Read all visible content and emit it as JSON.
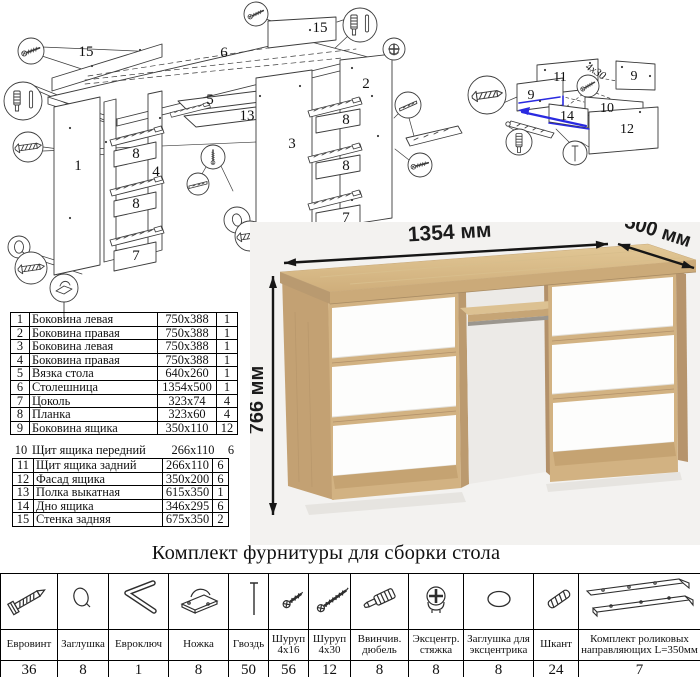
{
  "hardware_title": "Комплект фурнитуры для сборки стола",
  "dimensions": {
    "width": "1354 мм",
    "depth": "500 мм",
    "height": "766 мм"
  },
  "colors": {
    "wood": "#d2b282",
    "wood_dark": "#c5a372",
    "drawer_white": "#fdfdfc",
    "highlight_blue": "#2a2ae0",
    "photo_bg": "#f3f2f0",
    "line": "#3c3c3c"
  },
  "parts": {
    "rows": [
      {
        "num": "1",
        "name": "Боковина левая",
        "size": "750x388",
        "qty": "1"
      },
      {
        "num": "2",
        "name": "Боковина правая",
        "size": "750x388",
        "qty": "1"
      },
      {
        "num": "3",
        "name": "Боковина левая",
        "size": "750x388",
        "qty": "1"
      },
      {
        "num": "4",
        "name": "Боковина правая",
        "size": "750x388",
        "qty": "1"
      },
      {
        "num": "5",
        "name": "Вязка стола",
        "size": "640x260",
        "qty": "1"
      },
      {
        "num": "6",
        "name": "Столешница",
        "size": "1354x500",
        "qty": "1"
      },
      {
        "num": "7",
        "name": "Цоколь",
        "size": "323x74",
        "qty": "4"
      },
      {
        "num": "8",
        "name": "Планка",
        "size": "323x60",
        "qty": "4"
      },
      {
        "num": "9",
        "name": "Боковина ящика",
        "size": "350x110",
        "qty": "12"
      },
      {
        "num": "10",
        "name": "Щит ящика передний",
        "size": "266x110",
        "qty": "6"
      },
      {
        "num": "11",
        "name": "Щит ящика задний",
        "size": "266x110",
        "qty": "6"
      },
      {
        "num": "12",
        "name": "Фасад ящика",
        "size": "350x200",
        "qty": "6"
      },
      {
        "num": "13",
        "name": "Полка выкатная",
        "size": "615x350",
        "qty": "1"
      },
      {
        "num": "14",
        "name": "Дно ящика",
        "size": "346x295",
        "qty": "6"
      },
      {
        "num": "15",
        "name": "Стенка задняя",
        "size": "675x350",
        "qty": "2"
      }
    ]
  },
  "hardware": {
    "items": [
      {
        "icon": "euro-screw-icon",
        "name": "Евровинт",
        "qty": "36"
      },
      {
        "icon": "cap-icon",
        "name": "Заглушка",
        "qty": "8"
      },
      {
        "icon": "hex-key-icon",
        "name": "Евроключ",
        "qty": "1"
      },
      {
        "icon": "foot-icon",
        "name": "Ножка",
        "qty": "8"
      },
      {
        "icon": "nail-icon",
        "name": "Гвоздь",
        "qty": "50"
      },
      {
        "icon": "screw-4x16-icon",
        "name": "Шуруп\n4x16",
        "qty": "56"
      },
      {
        "icon": "screw-4x30-icon",
        "name": "Шуруп\n4x30",
        "qty": "12"
      },
      {
        "icon": "screw-dowel-icon",
        "name": "Ввинчив.\nдюбель",
        "qty": "8"
      },
      {
        "icon": "cam-lock-icon",
        "name": "Эксцентр.\nстяжка",
        "qty": "8"
      },
      {
        "icon": "cam-cap-icon",
        "name": "Заглушка для\nэксцентрика",
        "qty": "8"
      },
      {
        "icon": "dowel-icon",
        "name": "Шкант",
        "qty": "24"
      },
      {
        "icon": "drawer-slides-icon",
        "name": "Комплект роликовых\nнаправляющих L=350мм",
        "qty": "7"
      }
    ]
  },
  "diagram": {
    "main_labels": [
      "15",
      "6",
      "15",
      "5",
      "13",
      "2",
      "8",
      "3",
      "1",
      "8",
      "4",
      "8",
      "7",
      "8",
      "7"
    ],
    "drawer_labels": [
      "11",
      "9",
      "4x30",
      "9",
      "10",
      "14",
      "12"
    ]
  }
}
